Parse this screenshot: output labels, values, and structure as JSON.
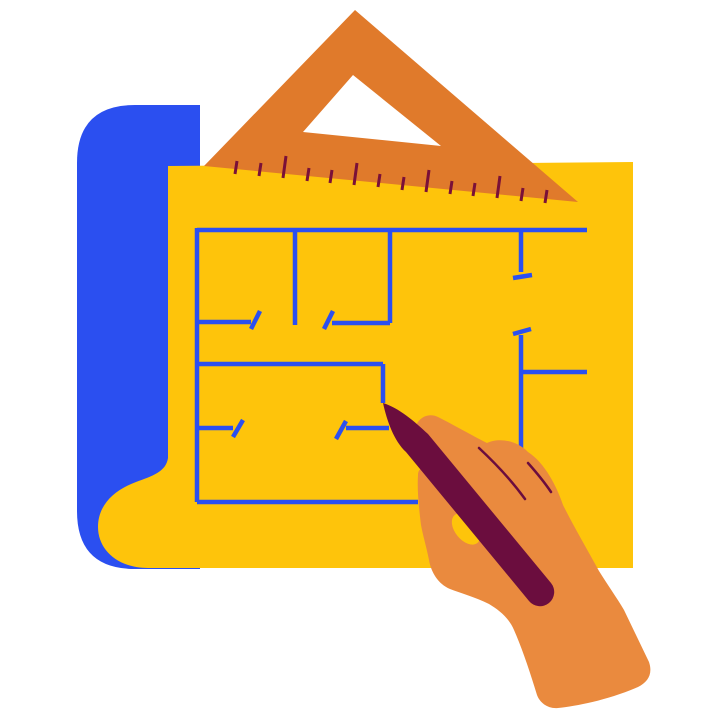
{
  "meta": {
    "title": "Blueprint drawing illustration",
    "description": "Flat vector illustration of a hand holding a dark maroon pencil drawing wall lines of a floor plan on a yellow blueprint sheet; a blue rolled paper edge shows on the left and an orange triangular set-square ruler rests along the top edge of the sheet.",
    "canvas_width": 720,
    "canvas_height": 720
  },
  "colors": {
    "background": "#FFFFFF",
    "blue": "#2B4FF0",
    "yellow": "#FEC40B",
    "ruler_orange": "#E07A2B",
    "hand_orange": "#EA8A3E",
    "pencil_maroon": "#6B0D3E",
    "tick_maroon": "#7A1038"
  },
  "scene": {
    "elements": [
      {
        "name": "paper-roll",
        "kind": "shape",
        "note": "blue rolled backing sheet, rounded left corners"
      },
      {
        "name": "blueprint-paper",
        "kind": "shape",
        "note": "yellow sheet with curled lower-left corner"
      },
      {
        "name": "floor-plan-lines",
        "kind": "line-drawing",
        "note": "blue wall lines with door-swing ticks, partially drawn"
      },
      {
        "name": "triangle-ruler",
        "kind": "shape",
        "note": "orange set-square with triangular cutout resting on top edge"
      },
      {
        "name": "ruler-tick-marks",
        "kind": "line-drawing",
        "note": "14 scale ticks, every third tick long"
      },
      {
        "name": "hand",
        "kind": "shape",
        "note": "orange hand and forearm gripping pencil"
      },
      {
        "name": "pencil",
        "kind": "shape",
        "note": "dark maroon pencil, tip touching an unfinished wall line"
      }
    ],
    "ruler": {
      "tick_count": 14,
      "long_tick_every": 3
    }
  }
}
